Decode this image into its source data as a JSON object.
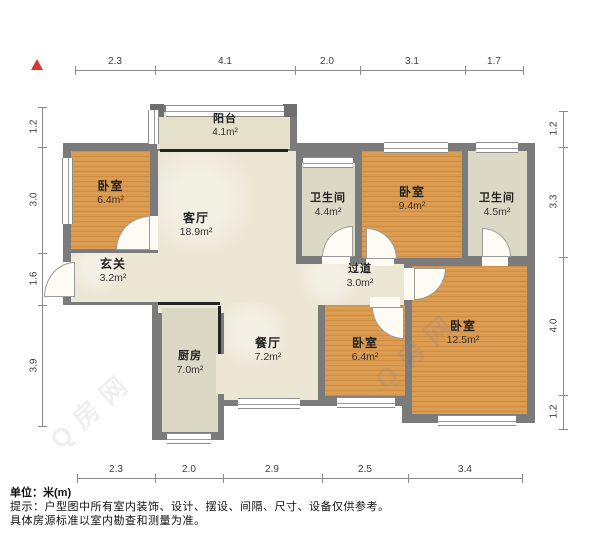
{
  "dimensions": {
    "unit": "m",
    "top": [
      "2.3",
      "4.1",
      "2.0",
      "3.1",
      "1.7"
    ],
    "bottom": [
      "2.3",
      "2.0",
      "2.9",
      "2.5",
      "3.4"
    ],
    "left": [
      "1.2",
      "3.0",
      "1.6",
      "3.9"
    ],
    "right": [
      "1.2",
      "3.3",
      "4.0",
      "1.2"
    ]
  },
  "rooms": {
    "balcony": {
      "name": "阳台",
      "area": "4.1m²"
    },
    "bedroom_tl": {
      "name": "卧室",
      "area": "6.4m²"
    },
    "living": {
      "name": "客厅",
      "area": "18.9m²"
    },
    "bath_a": {
      "name": "卫生间",
      "area": "4.4m²"
    },
    "bedroom_top": {
      "name": "卧室",
      "area": "9.4m²"
    },
    "bath_b": {
      "name": "卫生间",
      "area": "4.5m²"
    },
    "entry": {
      "name": "玄关",
      "area": "3.2m²"
    },
    "hallway": {
      "name": "过道",
      "area": "3.0m²"
    },
    "kitchen": {
      "name": "厨房",
      "area": "7.0m²"
    },
    "dining": {
      "name": "餐厅",
      "area": "7.2m²"
    },
    "bedroom_mid": {
      "name": "卧室",
      "area": "6.4m²"
    },
    "bedroom_br": {
      "name": "卧室",
      "area": "12.5m²"
    }
  },
  "watermark": {
    "text": "Q房网"
  },
  "footer": {
    "unit_label": "单位：米(m)",
    "tip_line1": "提示：户型图中所有室内装饰、设计、摆设、间隔、尺寸、设备仅供参考。",
    "tip_line2": "具体房源标准以室内勘查和测量为准。"
  },
  "colors": {
    "wall": "#7b7b7b",
    "wood_floor": "#dc9a4e",
    "tile_floor": "#dcd8c6",
    "beige_floor": "#ece6d4",
    "balcony_floor": "#e4e0ca",
    "north_arrow": "#d23a2e"
  }
}
